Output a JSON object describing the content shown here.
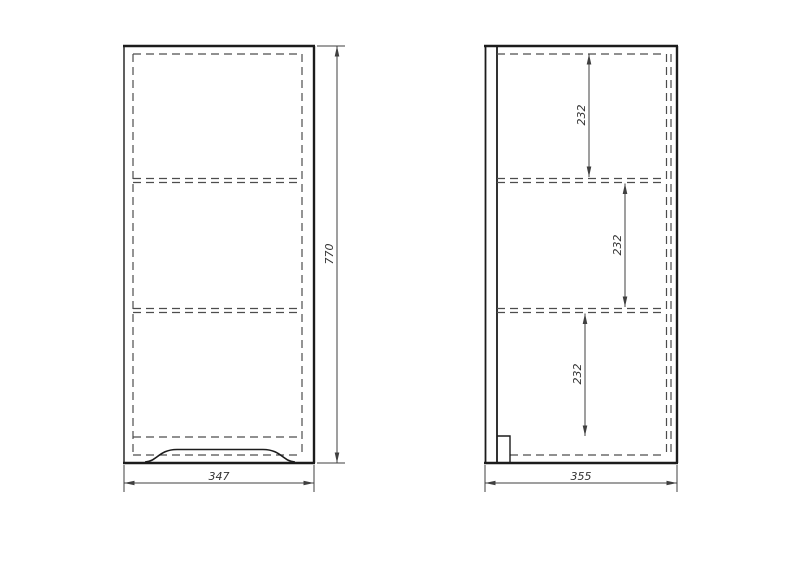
{
  "front_view": {
    "width_label": "347",
    "height_label": "770"
  },
  "side_view": {
    "depth_label": "355",
    "section_labels": [
      "232",
      "232",
      "232"
    ]
  },
  "colors": {
    "background": "#ffffff",
    "outline": "#1c1c1c",
    "hidden_line": "#4d4d4d",
    "dimension": "#3f3f3f",
    "text": "#333333"
  }
}
